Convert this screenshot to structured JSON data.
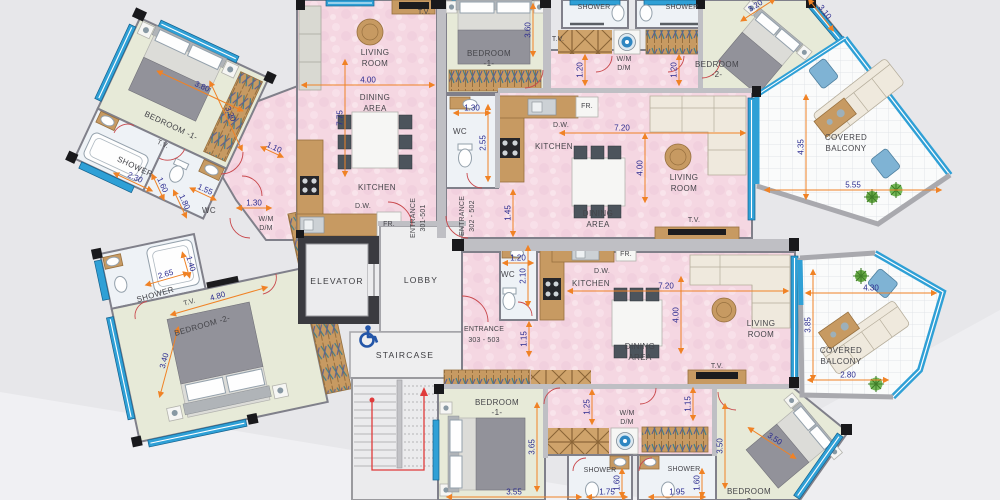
{
  "t": {
    "bedroom1_line": "BEDROOM -1-",
    "bedroom2_line": "BEDROOM -2-",
    "bedroom": "BEDROOM",
    "no1": "-1-",
    "no2": "-2-",
    "living": "LIVING",
    "room": "ROOM",
    "dining": "DINING",
    "area": "AREA",
    "kitchen": "KITCHEN",
    "shower": "SHOWER",
    "wc": "WC",
    "tv": "T.V.",
    "dw": "D.W.",
    "fr": "FR.",
    "wm": "W/M",
    "dm": "D/M",
    "elevator": "ELEVATOR",
    "lobby": "LOBBY",
    "staircase": "STAIRCASE",
    "entrance": "ENTRANCE",
    "ent301": "301-501",
    "ent302": "302 - 502",
    "ent303": "303 - 503",
    "covered": "COVERED",
    "balcony": "BALCONY"
  },
  "d": {
    "d110": "1.10",
    "d115": "1.15",
    "d120": "1.20",
    "d125": "1.25",
    "d130": "1.30",
    "d140": "1.40",
    "d145": "1.45",
    "d155": "1.55",
    "d160": "1.60",
    "d175": "1.75",
    "d180": "1.80",
    "d195": "1.95",
    "d210": "2.10",
    "d230": "2.30",
    "d255": "2.55",
    "d265": "2.65",
    "d280": "2.80",
    "d310": "3.10",
    "d320": "3.20",
    "d340": "3.40",
    "d350": "3.50",
    "d355": "3.55",
    "d360": "3.60",
    "d365": "3.65",
    "d380": "3.80",
    "d385": "3.85",
    "d400": "4.00",
    "d430": "4.30",
    "d435": "4.35",
    "d480": "4.80",
    "d555": "5.55",
    "d720": "7.20",
    "d775": "7.75"
  },
  "palette": {
    "wall": "#55555a",
    "pink": "#f5d7e2",
    "green": "#e7ead8",
    "wet": "#eef2f6",
    "window_blue": "#2fa0d6",
    "wood": "#c79a62",
    "dim_text": "#2b2b8f",
    "arrow_orange": "#f08225",
    "door_red": "#c8474b",
    "background": "#e7e7ea"
  },
  "icons": {
    "washing_machine": "washing-machine-icon",
    "wheelchair": "wheelchair-icon",
    "plant": "plant-icon"
  }
}
